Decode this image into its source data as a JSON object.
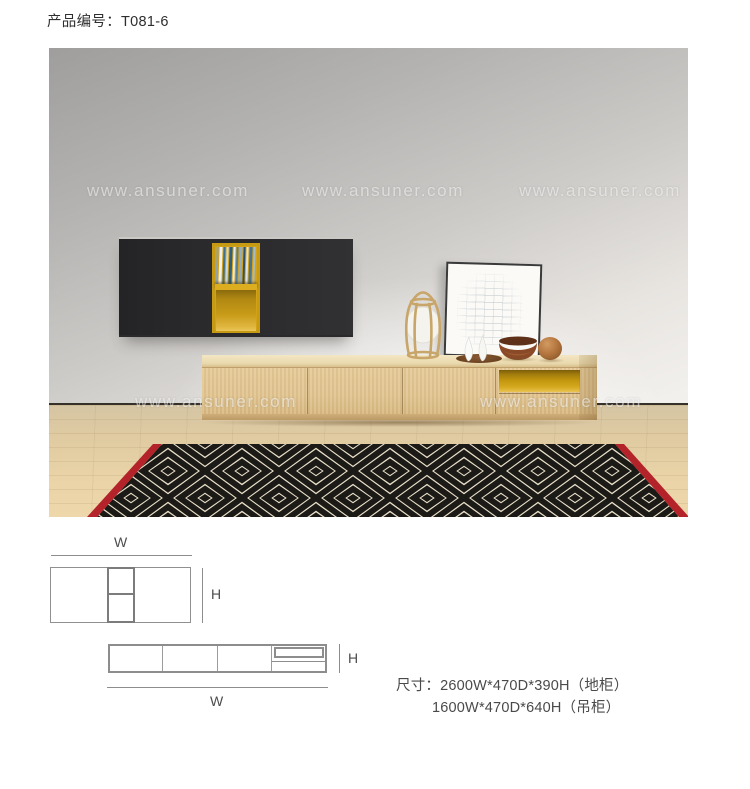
{
  "header": {
    "product_code": "产品编号：T081-6"
  },
  "photo": {
    "watermark_text": "www.ansuner.com",
    "books": {
      "colors": [
        "#8fa3ad",
        "#eef0ef",
        "#3f7292",
        "#cdd9dd",
        "#2f5f7e",
        "#e4e9ea",
        "#577f9b",
        "#97adb8",
        "#31506a",
        "#dce2e3",
        "#497590",
        "#a6bac3"
      ]
    }
  },
  "diagram_top": {
    "width_label": "W",
    "height_label": "H"
  },
  "diagram_bottom": {
    "width_label": "W",
    "height_label": "H"
  },
  "dimensions": {
    "line1": "尺寸：2600W*470D*390H（地柜）",
    "line2": "1600W*470D*640H（吊柜）"
  },
  "colors": {
    "accent-yellow": "#d2a117",
    "cabinet-dark": "#2a2a2c",
    "rug-red": "#b42329",
    "rug-black": "#1b1a17",
    "rug-cream": "#eae0c9",
    "skirting": "#35302a"
  }
}
